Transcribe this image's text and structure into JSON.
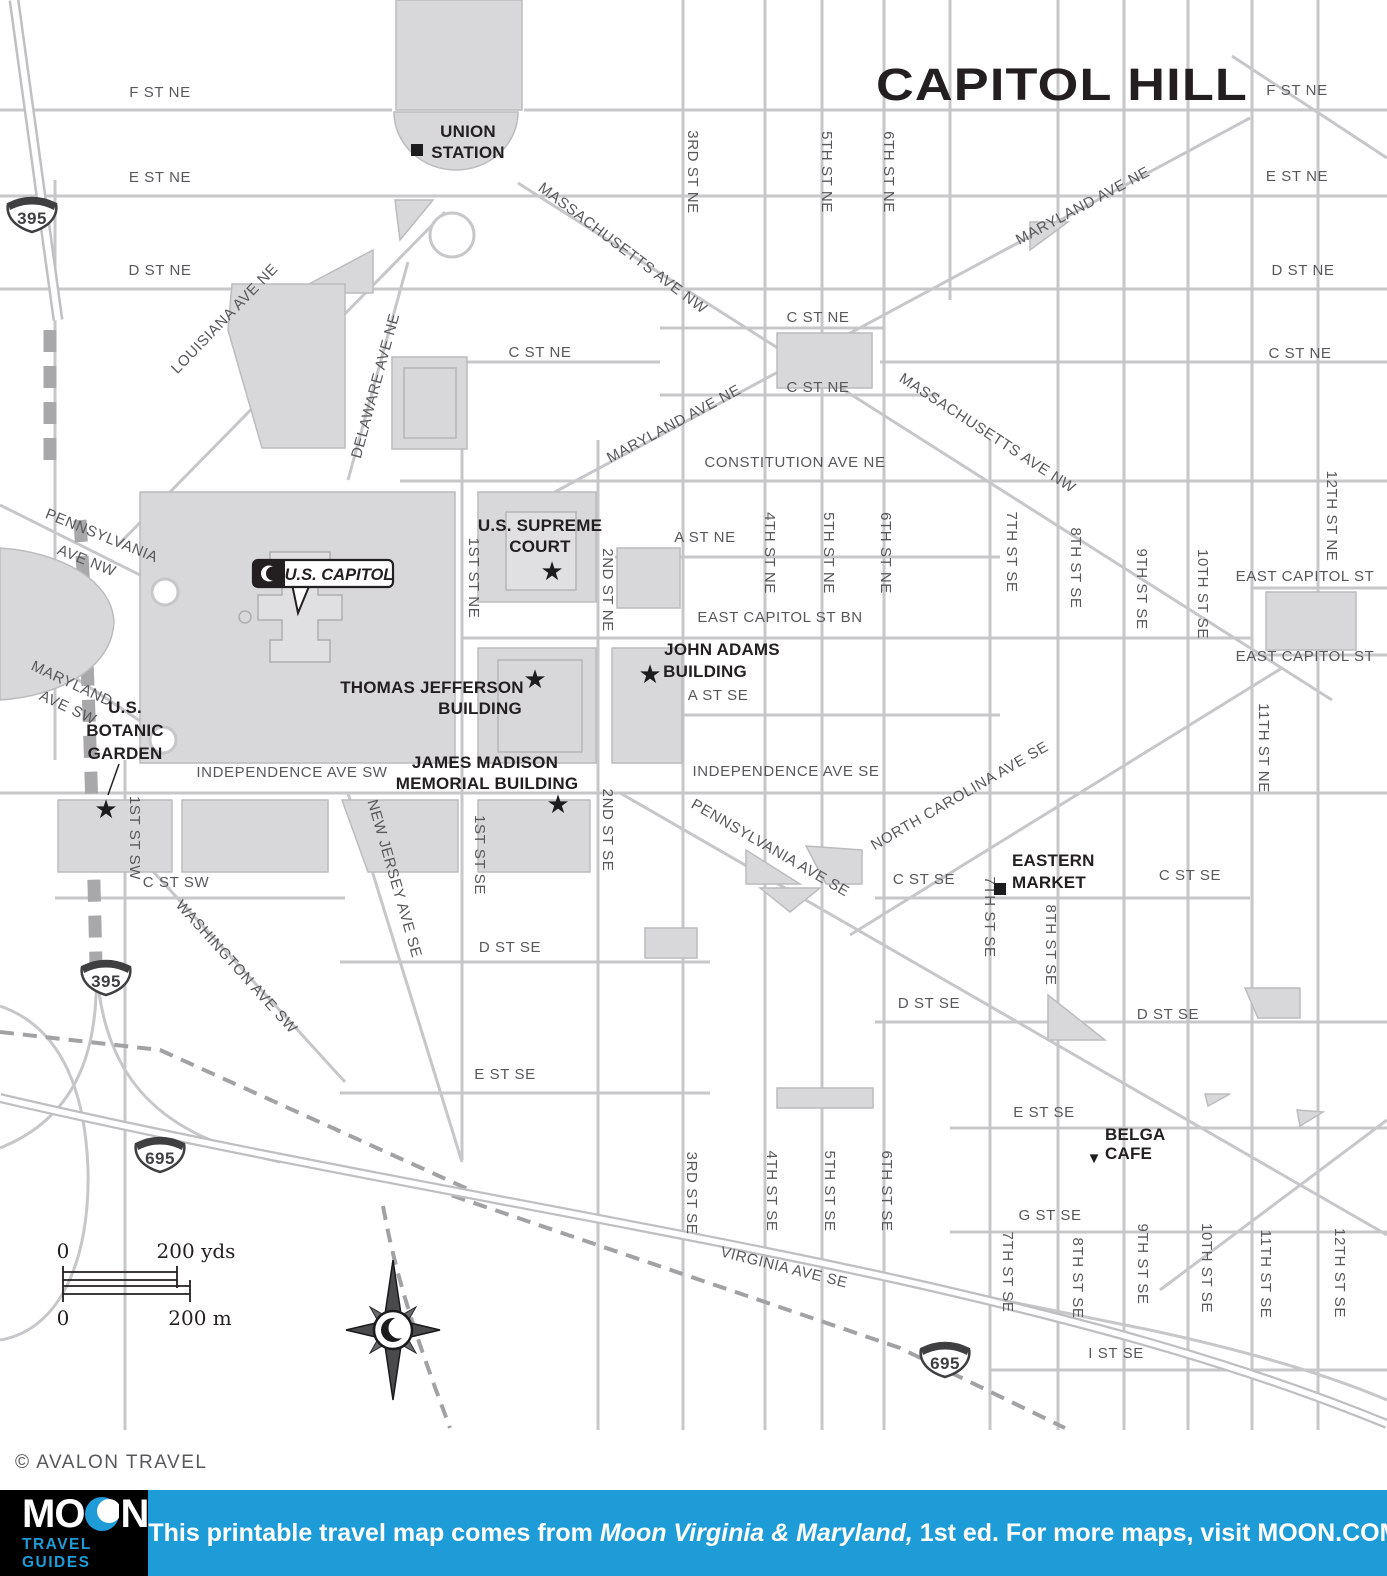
{
  "title": "CAPITOL HILL",
  "attribution": "© AVALON TRAVEL",
  "callout": {
    "label": "U.S. CAPITOL"
  },
  "scale_bar": {
    "zero_top": "0",
    "top": "200 yds",
    "zero_bottom": "0",
    "bottom": "200 m"
  },
  "shields": [
    "395",
    "395",
    "695",
    "695"
  ],
  "pois": {
    "union_station": [
      "UNION",
      "STATION"
    ],
    "supreme_court": [
      "U.S. SUPREME",
      "COURT"
    ],
    "jefferson": [
      "THOMAS JEFFERSON",
      "BUILDING"
    ],
    "adams": [
      "JOHN ADAMS",
      "BUILDING"
    ],
    "madison": [
      "JAMES MADISON",
      "MEMORIAL BUILDING"
    ],
    "botanic": [
      "U.S.",
      "BOTANIC",
      "GARDEN"
    ],
    "eastern_market": [
      "EASTERN",
      "MARKET"
    ],
    "belga": [
      "BELGA",
      "CAFE"
    ]
  },
  "labels_h": [
    "F ST NE",
    "E ST NE",
    "D ST NE",
    "F ST NE",
    "E ST NE",
    "D ST NE",
    "C ST NE",
    "C ST NE",
    "C ST NE",
    "C ST NE",
    "CONSTITUTION AVE NE",
    "A ST NE",
    "EAST CAPITOL ST BN",
    "A ST SE",
    "EAST CAPITOL ST",
    "EAST CAPITOL ST",
    "INDEPENDENCE AVE SW",
    "INDEPENDENCE AVE SE",
    "C ST SW",
    "C ST SE",
    "C ST SE",
    "D ST SE",
    "D ST SE",
    "D ST SE",
    "E ST SE",
    "E ST SE",
    "G ST SE",
    "I ST SE"
  ],
  "labels_v": [
    "3RD ST NE",
    "5TH ST NE",
    "6TH ST NE",
    "1ST ST NE",
    "2ND ST NE",
    "4TH ST NE",
    "5TH ST NE",
    "6TH ST NE",
    "7TH ST SE",
    "8TH ST SE",
    "9TH ST SE",
    "10TH ST SE",
    "11TH ST NE",
    "12TH ST NE",
    "1ST ST SW",
    "1ST ST SE",
    "2ND ST SE",
    "7TH ST SE",
    "8TH ST SE",
    "3RD ST SE",
    "4TH ST SE",
    "5TH ST SE",
    "6TH ST SE",
    "7TH ST SE",
    "8TH ST SE",
    "9TH ST SE",
    "10TH ST SE",
    "11TH ST SE",
    "12TH ST SE"
  ],
  "labels_d": [
    "MASSACHUSETTS AVE NW",
    "MASSACHUSETTS AVE NW",
    "MARYLAND AVE NE",
    "MARYLAND AVE NE",
    "LOUISIANA AVE NE",
    "DELAWARE AVE NE",
    "PENNSYLVANIA",
    "AVE NW",
    "MARYLAND",
    "AVE SW",
    "WASHINGTON AVE SW",
    "NEW JERSEY AVE SE",
    "PENNSYLVANIA AVE SE",
    "NORTH CAROLINA AVE SE",
    "VIRGINIA AVE SE"
  ],
  "footer": {
    "logo_mo": "MO",
    "logo_n": "N",
    "logo_sub": "TRAVEL GUIDES",
    "text_1": "This printable travel map comes from ",
    "text_italic": "Moon Virginia & Maryland,",
    "text_2": " 1st ed. For more maps, visit MOON.COM."
  }
}
